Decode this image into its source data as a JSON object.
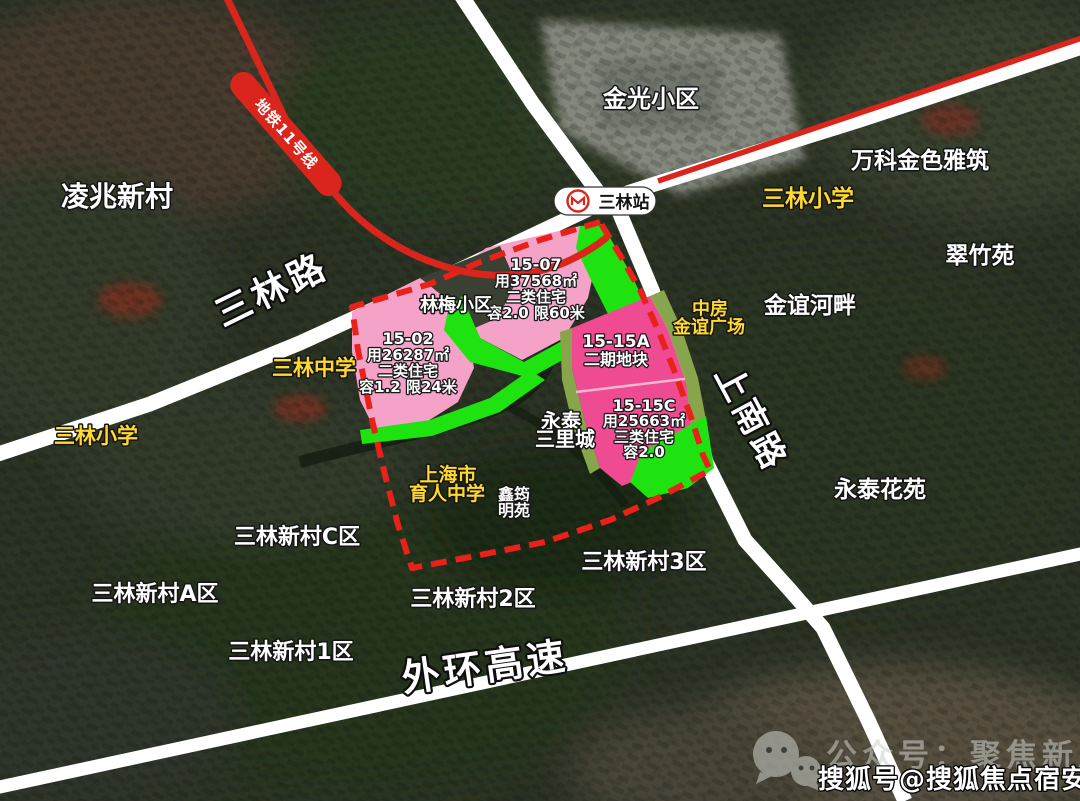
{
  "metro": {
    "line_label": "地铁11号线",
    "station_label": "三林站"
  },
  "roads": {
    "sanlin_road": "三林路",
    "shangnan_road": "上南路",
    "outer_ring_expressway": "外环高速"
  },
  "parcels": {
    "p1507": {
      "lines": [
        "15-07",
        "用37568㎡",
        "二类住宅",
        "容2.0 限60米"
      ]
    },
    "p1502": {
      "lines": [
        "15-02",
        "用26287㎡",
        "二类住宅",
        "容1.2 限24米"
      ]
    },
    "p1515a": {
      "lines": [
        "15-15A",
        "二期地块"
      ]
    },
    "p1515c": {
      "lines": [
        "15-15C",
        "用25663㎡",
        "三类住宅",
        "容2.0"
      ]
    }
  },
  "neighborhoods": {
    "lingzhao": "凌兆新村",
    "jinguang": "金光小区",
    "vanke_jinse": "万科金色雅筑",
    "cuizhuyuan": "翠竹苑",
    "jinyi_hepan": "金谊河畔",
    "linmei": "林梅小区",
    "yongtai_l1": "永泰",
    "yongtai_l2": "三里城",
    "xinyun_l1": "鑫筠",
    "xinyun_l2": "明苑",
    "yongtai_huayuan": "永泰花苑",
    "xincun_c": "三林新村C区",
    "xincun_a": "三林新村A区",
    "xincun_1": "三林新村1区",
    "xincun_2": "三林新村2区",
    "xincun_3": "三林新村3区"
  },
  "yellow_pois": {
    "sanlin_primary_east": "三林小学",
    "sanlin_primary_west": "三林小学",
    "sanlin_middle": "三林中学",
    "yuren_l1": "上海市",
    "yuren_l2": "育人中学",
    "zhongfang_l1": "中房",
    "zhongfang_l2": "金谊广场"
  },
  "watermarks": {
    "wechat": "公众号：聚焦新房",
    "sohu": "搜狐号@搜狐焦点宿安站"
  },
  "colors": {
    "parcel_pink": "#f5a2c9",
    "parcel_magenta": "#ee4b92",
    "greenbelt": "#1fe211",
    "olive_strip": "#87a54b",
    "metro_red": "#d9251c",
    "label_yellow": "#ffd92e",
    "road_white": "#ffffff"
  }
}
